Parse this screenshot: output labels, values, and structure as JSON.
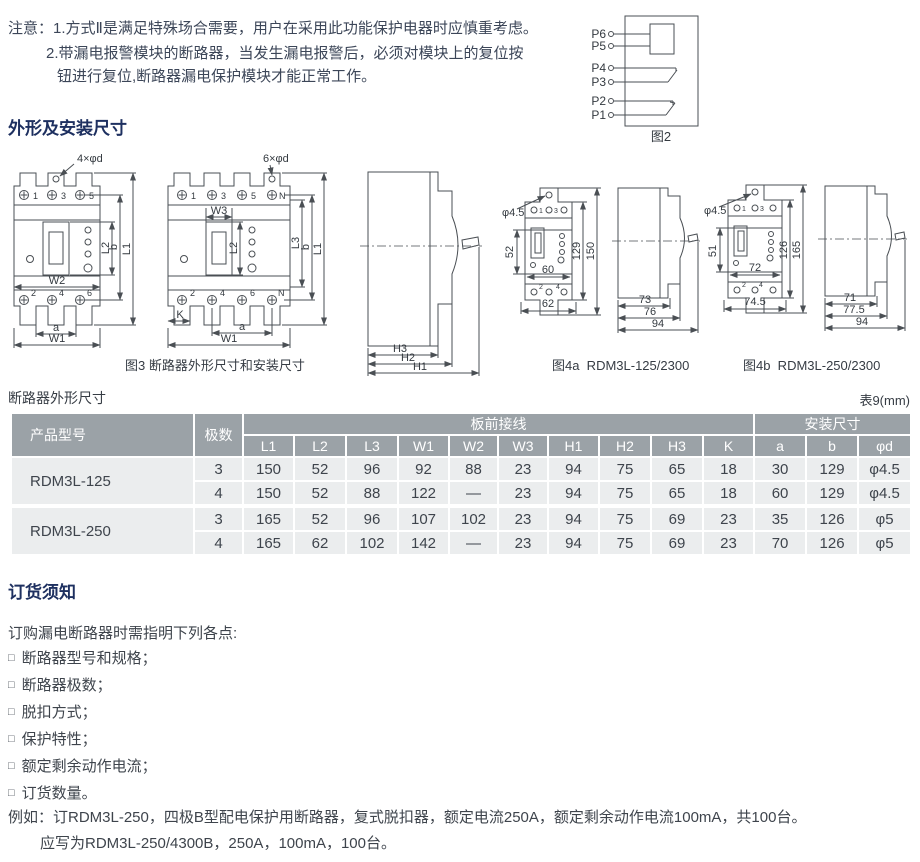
{
  "notice": {
    "line1": "注意：1.方式Ⅱ是满足特殊场合需要，用户在采用此功能保护电器时应慎重考虑。",
    "line2": "2.带漏电报警模块的断路器，当发生漏电报警后，必须对模块上的复位按",
    "line3": "钮进行复位,断路器漏电保护模块才能正常工作。"
  },
  "sections": {
    "dimensions_title": "外形及安装尺寸",
    "ordering_title": "订货须知"
  },
  "fig2": {
    "caption": "图2",
    "terminals": [
      "P6",
      "P5",
      "P4",
      "P3",
      "P2",
      "P1"
    ]
  },
  "fig3": {
    "caption": "图3 断路器外形尺寸和安装尺寸",
    "front3p": {
      "drill_note": "4×φd",
      "top_terminals": [
        "1",
        "3",
        "5"
      ],
      "bottom_terminals": [
        "2",
        "4",
        "6"
      ],
      "dims": {
        "w2": "W2",
        "a": "a",
        "w1": "W1",
        "l2": "L2",
        "b": "b",
        "l1": "L1"
      }
    },
    "front4p": {
      "drill_note": "6×φd",
      "top_terminals": [
        "1",
        "3",
        "5",
        "N"
      ],
      "bottom_terminals": [
        "2",
        "4",
        "6",
        "N"
      ],
      "dims": {
        "w3": "W3",
        "k": "K",
        "a": "a",
        "w1": "W1",
        "l2": "L2",
        "l3": "L3",
        "b": "b",
        "l1": "L1"
      }
    },
    "side": {
      "dims": {
        "h3": "H3",
        "h2": "H2",
        "h1": "H1"
      }
    }
  },
  "fig4a": {
    "caption": "图4a  RDM3L-125/2300",
    "front": {
      "drill_note": "φ4.5",
      "top_terminals": [
        "1",
        "3"
      ],
      "bottom_terminals": [
        "2",
        "4"
      ],
      "dims": {
        "v52": "52",
        "w60": "60",
        "w62": "62",
        "h129": "129",
        "h150": "150"
      }
    },
    "side": {
      "dims": {
        "d73": "73",
        "d76": "76",
        "d94": "94"
      }
    }
  },
  "fig4b": {
    "caption": "图4b  RDM3L-250/2300",
    "front": {
      "drill_note": "φ4.5",
      "top_terminals": [
        "1",
        "3"
      ],
      "bottom_terminals": [
        "2",
        "4"
      ],
      "dims": {
        "v51": "51",
        "w72": "72",
        "w745": "74.5",
        "h126": "126",
        "h165": "165"
      }
    },
    "side": {
      "dims": {
        "d71": "71",
        "d775": "77.5",
        "d94": "94"
      }
    }
  },
  "table": {
    "title": "断路器外形尺寸",
    "unit_note": "表9(mm)",
    "header": {
      "product": "产品型号",
      "poles": "极数",
      "group1": "板前接线",
      "group2": "安装尺寸",
      "cols1": [
        "L1",
        "L2",
        "L3",
        "W1",
        "W2",
        "W3",
        "H1",
        "H2",
        "H3",
        "K"
      ],
      "cols2": [
        "a",
        "b",
        "φd"
      ]
    },
    "groups": [
      {
        "model": "RDM3L-125",
        "rows": [
          {
            "poles": "3",
            "values": [
              "150",
              "52",
              "96",
              "92",
              "88",
              "23",
              "94",
              "75",
              "65",
              "18",
              "30",
              "129",
              "φ4.5"
            ]
          },
          {
            "poles": "4",
            "values": [
              "150",
              "52",
              "88",
              "122",
              "—",
              "23",
              "94",
              "75",
              "65",
              "18",
              "60",
              "129",
              "φ4.5"
            ]
          }
        ]
      },
      {
        "model": "RDM3L-250",
        "rows": [
          {
            "poles": "3",
            "values": [
              "165",
              "52",
              "96",
              "107",
              "102",
              "23",
              "94",
              "75",
              "69",
              "23",
              "35",
              "126",
              "φ5"
            ]
          },
          {
            "poles": "4",
            "values": [
              "165",
              "62",
              "102",
              "142",
              "—",
              "23",
              "94",
              "75",
              "69",
              "23",
              "70",
              "126",
              "φ5"
            ]
          }
        ]
      }
    ]
  },
  "ordering": {
    "intro": "订购漏电断路器时需指明下列各点:",
    "bullet_glyph": "□",
    "items": [
      "断路器型号和规格；",
      "断路器极数；",
      "脱扣方式；",
      "保护特性；",
      "额定剩余动作电流；",
      "订货数量。"
    ],
    "example_line1": "例如：订RDM3L-250，四极B型配电保护用断路器，复式脱扣器，额定电流250A，额定剩余动作电流100mA，共100台。",
    "example_line2": "应写为RDM3L-250/4300B，250A，100mA，100台。"
  }
}
